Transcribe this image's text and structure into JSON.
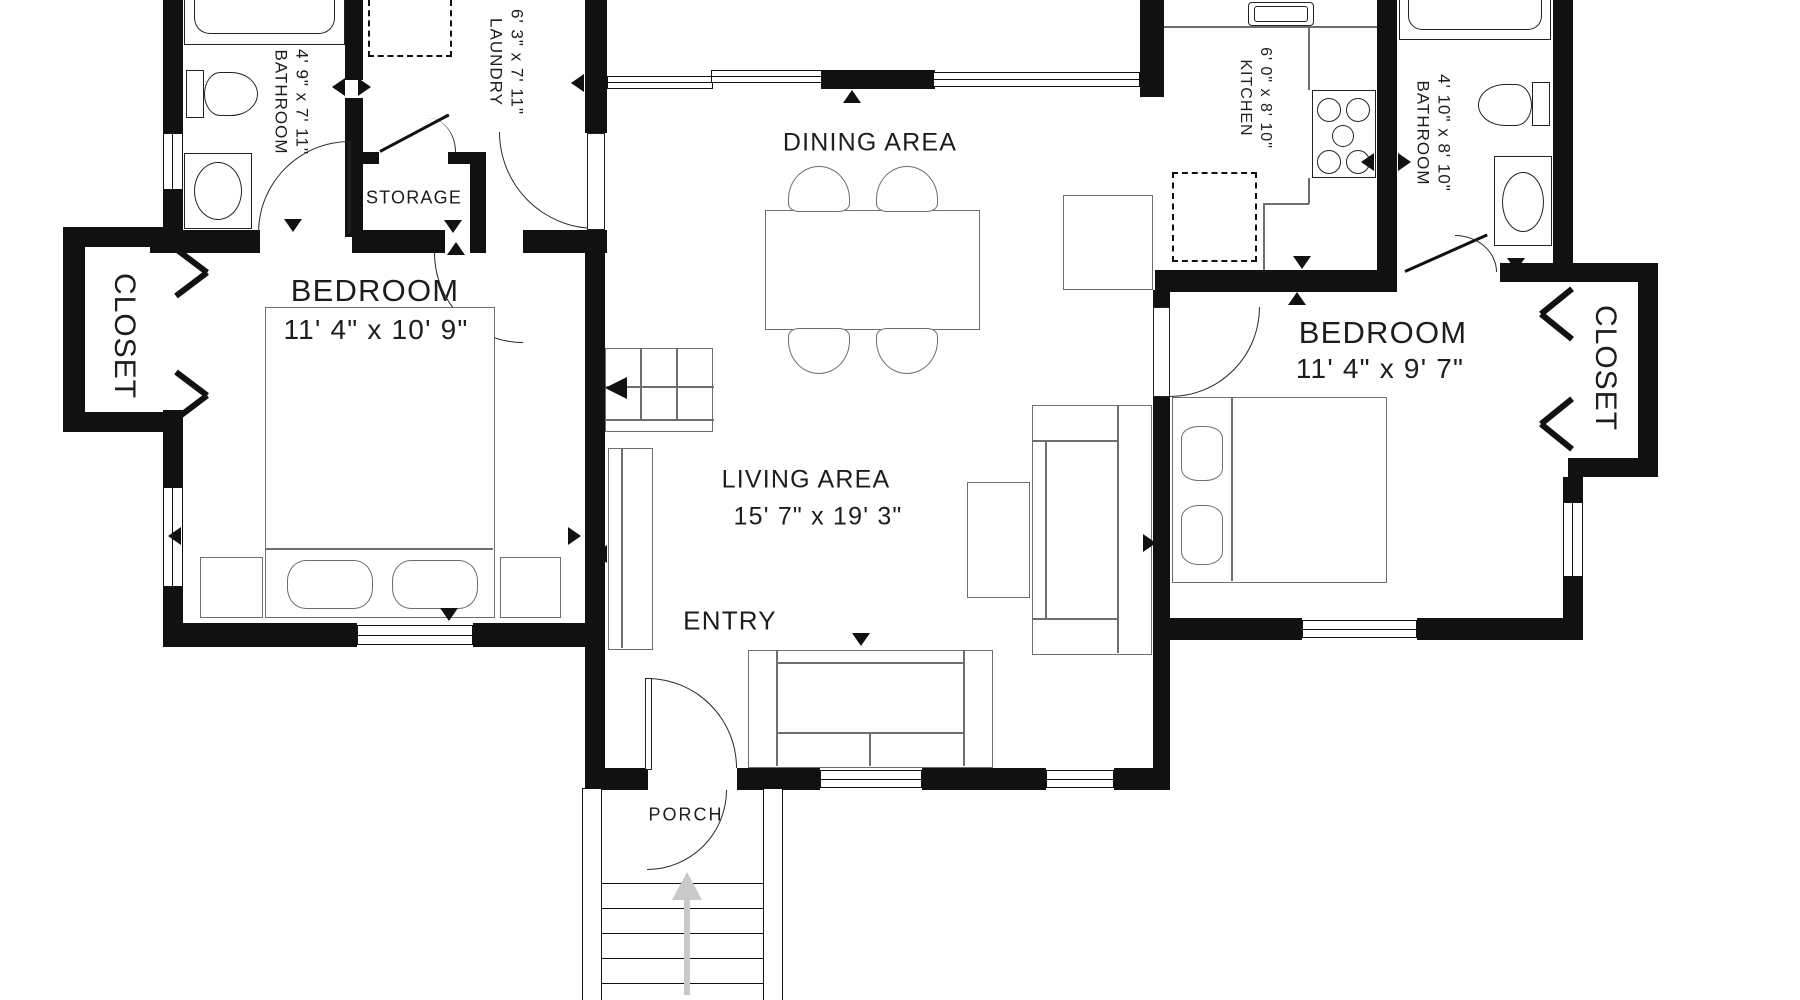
{
  "rooms": {
    "bedroom_left": {
      "name": "BEDROOM",
      "dims": "11' 4\" x 10' 9\""
    },
    "closet_left": {
      "name": "CLOSET"
    },
    "bathroom_left": {
      "name": "BATHROOM",
      "dims": "4' 9\" x 7' 11\""
    },
    "storage": {
      "name": "STORAGE"
    },
    "laundry": {
      "name": "LAUNDRY",
      "dims": "6' 3\" x 7' 11\""
    },
    "dining": {
      "name": "DINING AREA"
    },
    "kitchen": {
      "name": "KITCHEN",
      "dims": "6' 0\" x 8' 10\""
    },
    "bathroom_right": {
      "name": "BATHROOM",
      "dims": "4' 10\" x 8' 10\""
    },
    "bedroom_right": {
      "name": "BEDROOM",
      "dims": "11' 4\" x 9' 7\""
    },
    "closet_right": {
      "name": "CLOSET"
    },
    "living": {
      "name": "LIVING AREA",
      "dims": "15' 7\" x 19' 3\""
    },
    "entry": {
      "name": "ENTRY"
    },
    "porch": {
      "name": "PORCH"
    }
  },
  "colors": {
    "wall": "#111111",
    "furniture_line": "#6e6e6e",
    "fixture_line": "#222222",
    "stair_arrow": "#c9c9c9",
    "background": "#ffffff"
  }
}
